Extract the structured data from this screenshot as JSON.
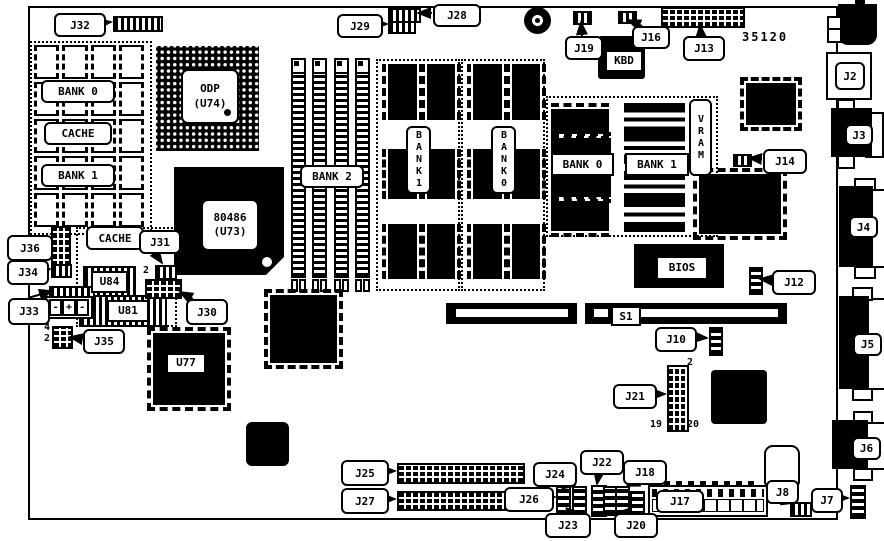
{
  "labels": {
    "j2": "J2",
    "j3": "J3",
    "j4": "J4",
    "j5": "J5",
    "j6": "J6",
    "j7": "J7",
    "j8": "J8",
    "j10": "J10",
    "j12": "J12",
    "j13": "J13",
    "j14": "J14",
    "j16": "J16",
    "j17": "J17",
    "j18": "J18",
    "j19": "J19",
    "j20": "J20",
    "j21": "J21",
    "j22": "J22",
    "j23": "J23",
    "j24": "J24",
    "j25": "J25",
    "j26": "J26",
    "j27": "J27",
    "j28": "J28",
    "j29": "J29",
    "j30": "J30",
    "j31": "J31",
    "j32": "J32",
    "j33": "J33",
    "j34": "J34",
    "j35": "J35",
    "j36": "J36",
    "s1": "S1"
  },
  "chips": {
    "cpu_line1": "80486",
    "cpu_line2": "(U73)",
    "odp_line1": "ODP",
    "odp_line2": "(U74)",
    "kbd": "KBD",
    "bios": "BIOS",
    "u77": "U77",
    "u81": "U81",
    "u84": "U84"
  },
  "memory": {
    "cache_bank0": "BANK 0",
    "cache_label": "CACHE",
    "cache_bank1": "BANK 1",
    "cache_label2": "CACHE",
    "simm_bank2": "BANK 2",
    "dram_bank1": "BANK1",
    "dram_bank0": "BANK0",
    "video_bank0": "BANK 0",
    "video_bank1": "BANK 1",
    "vram": "VRAM"
  },
  "annotations": {
    "board_number": "35120",
    "j21_pin2": "2",
    "j21_pin19": "19",
    "j21_pin20": "20",
    "j31_pin2": "2",
    "j35_pin4": "4",
    "j35_pin2": "2",
    "battery_neg1": "-",
    "battery_plus": "+",
    "battery_neg2": "-"
  }
}
